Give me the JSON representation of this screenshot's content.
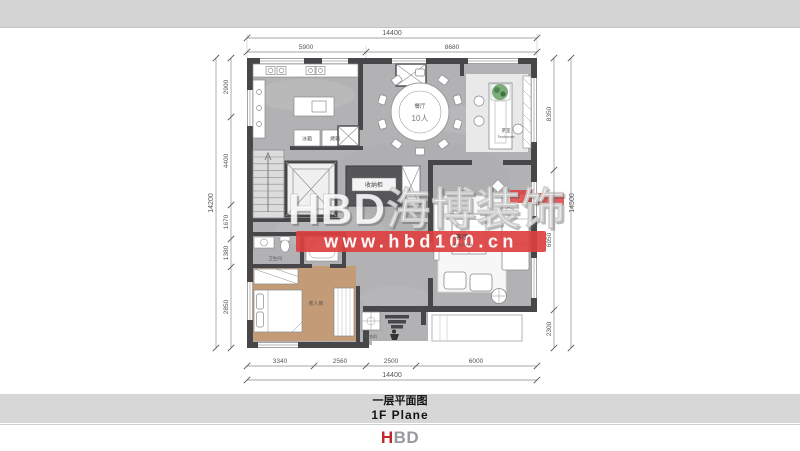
{
  "caption": {
    "cn": "一层平面图",
    "en": "1F  Plane"
  },
  "logo": {
    "part1": "H",
    "part2": "BD"
  },
  "watermark": {
    "brand": "HBD海博装饰",
    "url": "www.hbd100.cn"
  },
  "dims": {
    "top": {
      "overall": "14400",
      "seg1": "5900",
      "seg2": "8680"
    },
    "bottom": {
      "overall": "14400",
      "seg1": "3340",
      "seg2": "2560",
      "seg3": "2500",
      "seg4": "6000"
    },
    "left": {
      "overall": "14200",
      "seg1": "2900",
      "seg2": "4400",
      "seg3": "1670",
      "seg4": "1380",
      "seg5": "2850"
    },
    "right": {
      "overall": "14500",
      "seg1": "8350",
      "seg2": "6950",
      "seg3": "2300"
    }
  },
  "rooms": {
    "dining": {
      "name": "餐厅",
      "capacity": "10人"
    },
    "tea": {
      "name": "茶室",
      "name_en": "Teahouse"
    },
    "living": {
      "name": "客厅",
      "name_en": "LIVING RM"
    },
    "bedroom": {
      "name": "老人房"
    },
    "bath": {
      "name": "卫生间"
    },
    "storage": {
      "name": "收纳柜"
    },
    "laundry": {
      "name": "洗衣机"
    },
    "kitchen": {
      "fridge": "冰箱",
      "oven": "烤箱"
    }
  },
  "colors": {
    "watermark_red": "#dd4040",
    "logo_red": "#c1272d",
    "logo_gray": "#97999c",
    "wall": "#47474a",
    "marble_floor": "#b2b1b3",
    "wood_floor": "#c49b77",
    "band_gray": "#d4d4d4"
  }
}
